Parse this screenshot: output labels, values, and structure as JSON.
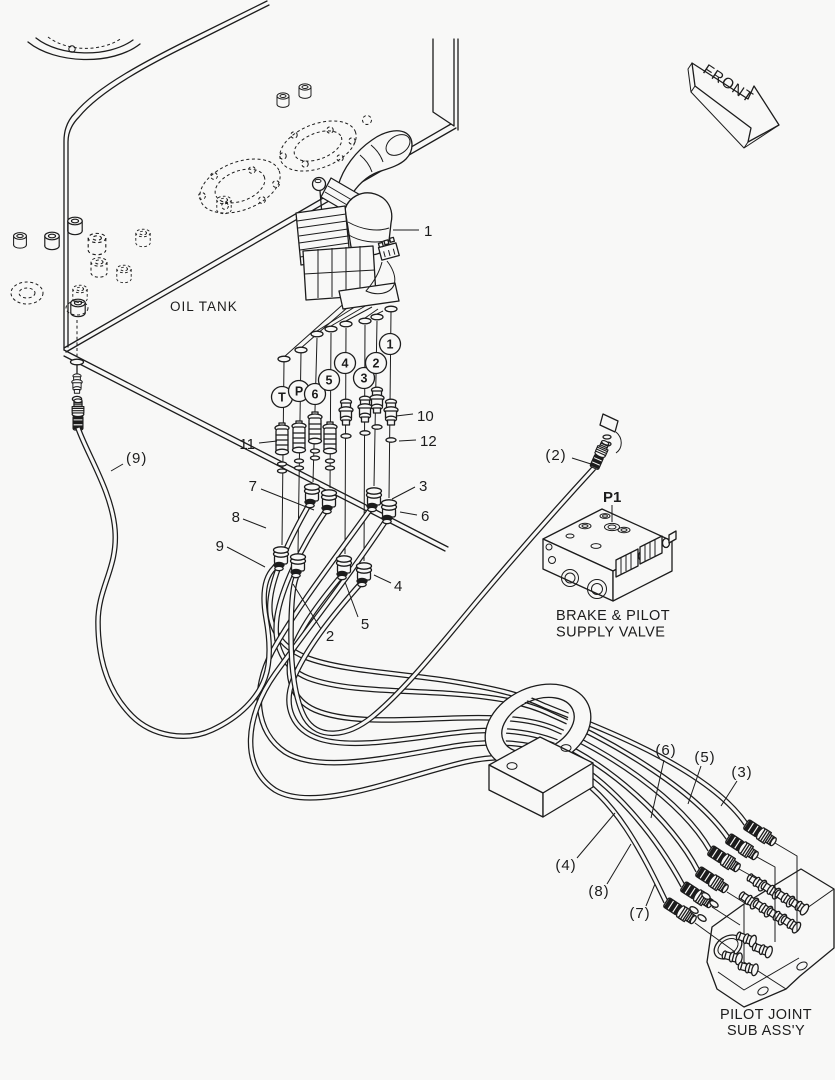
{
  "colors": {
    "background": "#f8f8f7",
    "line": "#1c1c1c"
  },
  "labels": {
    "oil_tank": "OIL TANK",
    "front": "FRONT",
    "valve_line1": "BRAKE & PILOT",
    "valve_line2": "SUPPLY VALVE",
    "joint_line1": "PILOT JOINT",
    "joint_line2": "SUB ASS'Y",
    "p1": "P1"
  },
  "part_callouts": {
    "i1": "1",
    "i2": "2",
    "i3": "3",
    "i4": "4",
    "i5": "5",
    "i6": "6",
    "i7": "7",
    "i8": "8",
    "i9": "9",
    "i10": "10",
    "i11": "11",
    "i12": "12"
  },
  "hose_callouts": {
    "h2": "(2)",
    "h3": "(3)",
    "h4": "(4)",
    "h5": "(5)",
    "h6": "(6)",
    "h7": "(7)",
    "h8": "(8)",
    "h9": "(9)"
  },
  "port_labels": {
    "t": "T",
    "p": "P",
    "n1": "1",
    "n2": "2",
    "n3": "3",
    "n4": "4",
    "n5": "5",
    "n6": "6"
  }
}
